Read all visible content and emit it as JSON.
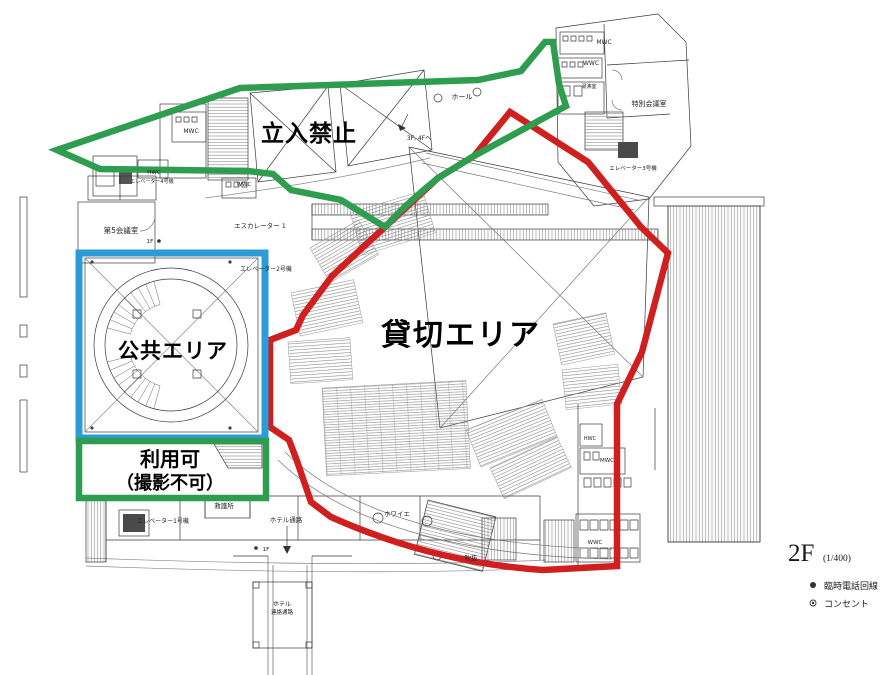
{
  "zones": {
    "no_entry": {
      "label": "立入禁止",
      "color": "#2e9d4f"
    },
    "reserved": {
      "label": "貸切エリア",
      "color": "#d01f1f"
    },
    "public": {
      "label": "公共エリア",
      "color": "#2b9cd8"
    },
    "usable": {
      "line1": "利用可",
      "line2": "（撮影不可）",
      "color": "#2e9d4f"
    }
  },
  "legend": {
    "floor": "2F",
    "scale": "(1/400)",
    "items": [
      {
        "symbol": "filled-circle",
        "label": "臨時電話回線"
      },
      {
        "symbol": "ringed-circle",
        "label": "コンセント"
      }
    ]
  },
  "labels": {
    "hall": "ホール",
    "to_upper_floors": "3F, 4Fへ",
    "mwc_nw": "MWC",
    "hwc_nw": "HWC",
    "wwc_n": "WWC",
    "elevator4": "エレベーター4号機",
    "mwc_ne": "MWC",
    "wwc_ne": "WWC",
    "kettle_room": "湯沸室",
    "special_meeting_room": "特別会議室",
    "elevator3": "エレベーター3号機",
    "meeting_room5": "第5会議室",
    "escalator1": "エスカレーター 1",
    "elevator2": "エレベーター2号機",
    "floor1_upper": "1F",
    "floor1_lower": "1F",
    "elevator1": "エレベーター1号機",
    "first_aid": "救護所",
    "hotel_corridor": "ホテル通路",
    "hotel_link_line1": "ホテル",
    "hotel_link_line2": "連絡通路",
    "foyer": "ホワイエ",
    "void_space": "吹抜",
    "wwc_se": "WWC",
    "hwc_e": "HWC",
    "mwc_e": "MWC"
  }
}
